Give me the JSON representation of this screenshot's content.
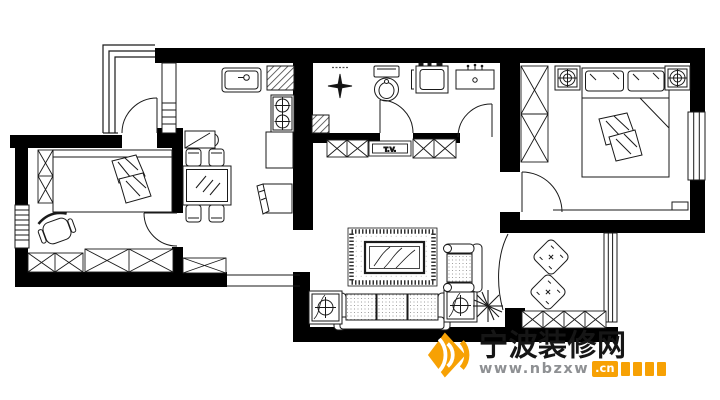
{
  "labels": {
    "tv_cabinet": "T.V."
  },
  "watermark": {
    "site_name": "宁波装修网",
    "url_prefix": "www.nbzxw",
    "url_suffix": ".cn",
    "blocks_count": 4
  },
  "colors": {
    "background": "#ffffff",
    "walls": "#000000",
    "lines": "#1a1a1a",
    "brand_orange": "#F7A104",
    "url_gray": "#8E9093",
    "site_name_black": "#161616"
  }
}
